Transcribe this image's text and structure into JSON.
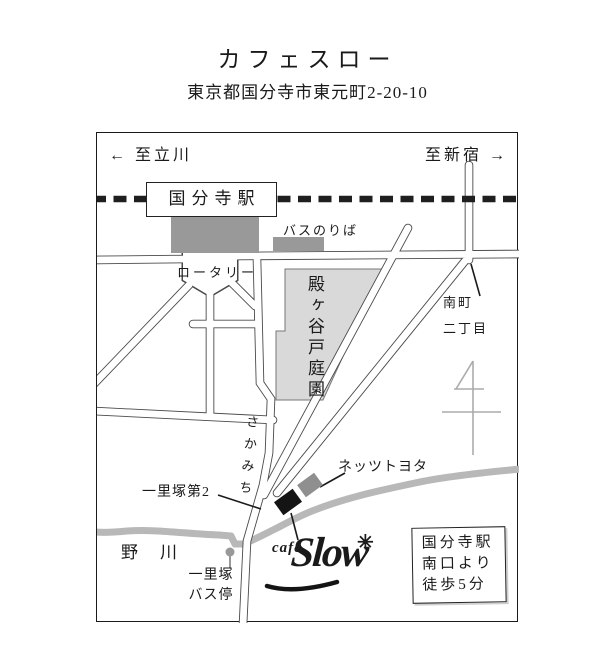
{
  "page": {
    "title": "カフェスロー",
    "address": "東京都国分寺市東元町2-20-10"
  },
  "map": {
    "directions": {
      "left_arrow": "←",
      "to_tachikawa": "至立川",
      "to_shinjuku": "至新宿",
      "right_arrow": "→"
    },
    "station": {
      "name": "国分寺駅"
    },
    "labels": {
      "bus_boarding": "バスのりば",
      "rotary": "ロータリー",
      "garden": "殿ヶ谷戸庭園",
      "minamicho_line1": "南町",
      "minamicho_line2": "二丁目",
      "sakamichi": "さかみち",
      "ichirizuka_dai2": "一里塚第2",
      "nogawa": "野川",
      "bus_stop_line1": "一里塚",
      "bus_stop_line2": "バス停",
      "netz_toyota": "ネッツトヨタ"
    },
    "logo": {
      "cafe": "café",
      "slow": "Slow",
      "star": "✳"
    },
    "info_box": {
      "line1": "国分寺駅",
      "line2": "南口より",
      "line3": "徒歩5分"
    },
    "colors": {
      "building_gray": "#999999",
      "garden_gray": "#d9d9d9",
      "river_gray": "#b8b8b8",
      "toyota_gray": "#8f8f8f",
      "ink": "#1a1a1a"
    }
  }
}
